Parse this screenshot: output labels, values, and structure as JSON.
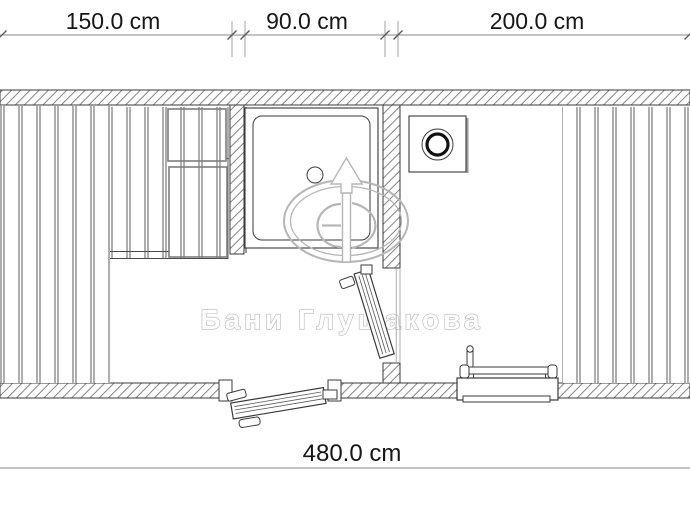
{
  "dimensions": {
    "top_segments": [
      {
        "label": "150.0 cm"
      },
      {
        "label": "90.0 cm"
      },
      {
        "label": "200.0 cm"
      }
    ],
    "bottom_total": {
      "label": "480.0 cm"
    }
  },
  "watermark": {
    "text": "Бани Глушакова",
    "logo_icon": "gd-arrow-emblem"
  },
  "colors": {
    "line": "#3a3a3a",
    "hatch": "#757575",
    "dim_line": "#8a8a8a",
    "dim_text": "#161616",
    "watermark": "#b6b6b6",
    "background": "#ffffff"
  }
}
